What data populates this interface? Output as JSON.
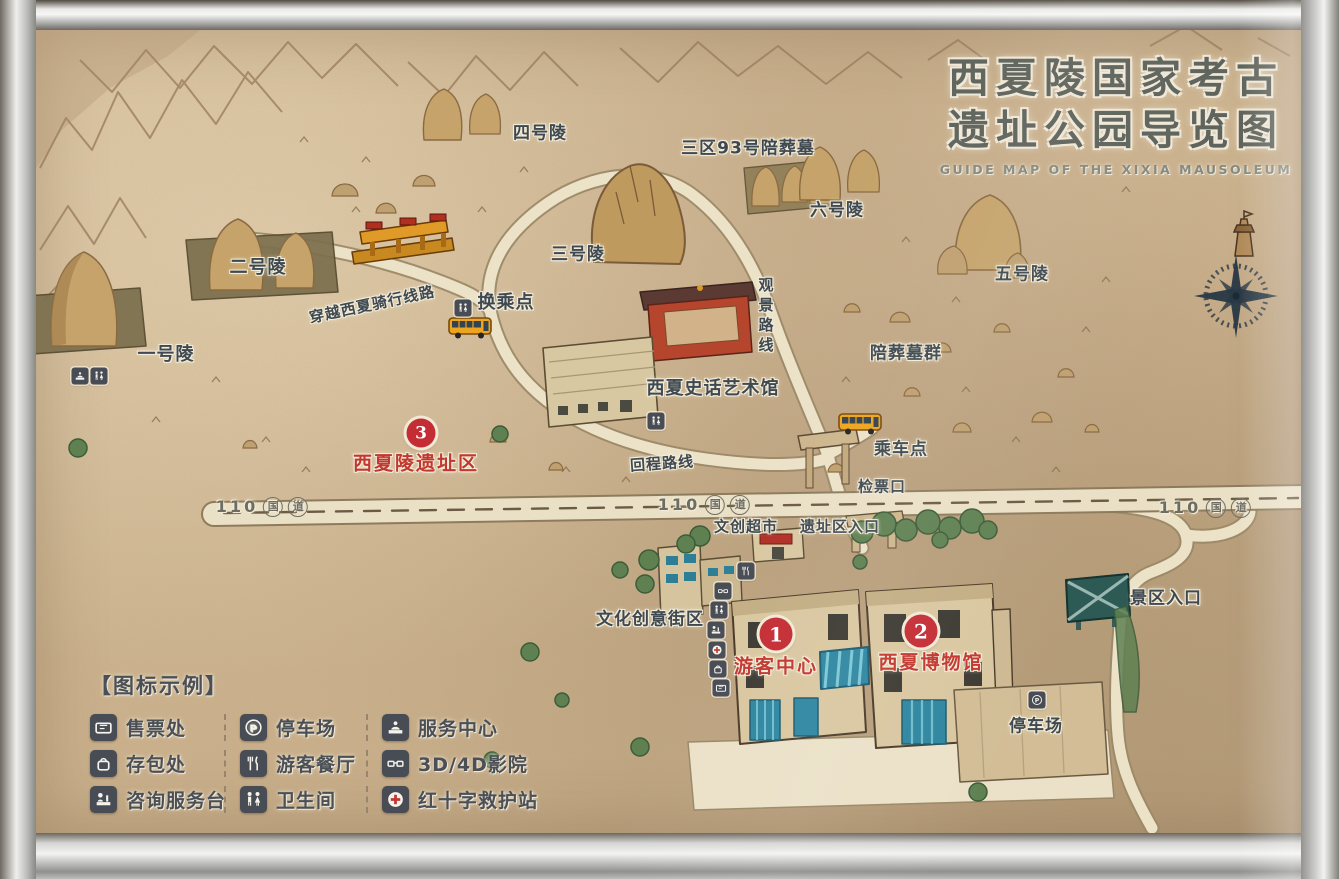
{
  "title": {
    "line1": "西夏陵国家考古",
    "line2": "遗址公园导览图",
    "english": "GUIDE MAP OF THE XIXIA MAUSOLEUM"
  },
  "places": {
    "tomb1": "一号陵",
    "tomb2": "二号陵",
    "tomb3": "三号陵",
    "tomb4": "四号陵",
    "tomb5": "五号陵",
    "tomb6": "六号陵",
    "tomb_group_93": "三区93号陪葬墓",
    "accompanying_tombs": "陪葬墓群",
    "transfer_point": "换乘点",
    "boarding_point": "乘车点",
    "ticket_gate": "检票口",
    "art_hall": "西夏史话艺术馆",
    "cultural_supermarket": "文创超市",
    "site_entrance": "遗址区入口",
    "creative_street": "文化创意街区",
    "scenic_entrance": "景区入口",
    "parking_lot": "停车场"
  },
  "markers": [
    {
      "number": "1",
      "label": "游客中心"
    },
    {
      "number": "2",
      "label": "西夏博物馆"
    },
    {
      "number": "3",
      "label": "西夏陵遗址区"
    }
  ],
  "routes": {
    "cycling": "穿越西夏骑行线路",
    "return": "回程路线",
    "viewing": "观景路线"
  },
  "road": {
    "number": "110",
    "char_guo": "国",
    "char_dao": "道"
  },
  "legend": {
    "title": "【图标示例】",
    "columns": [
      {
        "items": [
          {
            "icon": "ticket-office-icon",
            "label": "售票处"
          },
          {
            "icon": "bag-storage-icon",
            "label": "存包处"
          },
          {
            "icon": "information-desk-icon",
            "label": "咨询服务台"
          }
        ]
      },
      {
        "items": [
          {
            "icon": "parking-icon",
            "label": "停车场"
          },
          {
            "icon": "restaurant-icon",
            "label": "游客餐厅"
          },
          {
            "icon": "toilet-icon",
            "label": "卫生间"
          }
        ]
      },
      {
        "items": [
          {
            "icon": "service-center-icon",
            "label": "服务中心"
          },
          {
            "icon": "cinema-icon",
            "label": "3D/4D影院"
          },
          {
            "icon": "first-aid-icon",
            "label": "红十字救护站"
          }
        ]
      }
    ]
  },
  "colors": {
    "sand": "#cdb38e",
    "road_cream": "#ece2c8",
    "marker_red": "#c42d34",
    "icon_bg": "#474c55",
    "glass_teal": "#2e86a0",
    "frame_silver": "#e9e9e7",
    "label_dark": "#3e4951",
    "mound_tan": "#c5a36b",
    "tree_green": "#5f8152"
  }
}
